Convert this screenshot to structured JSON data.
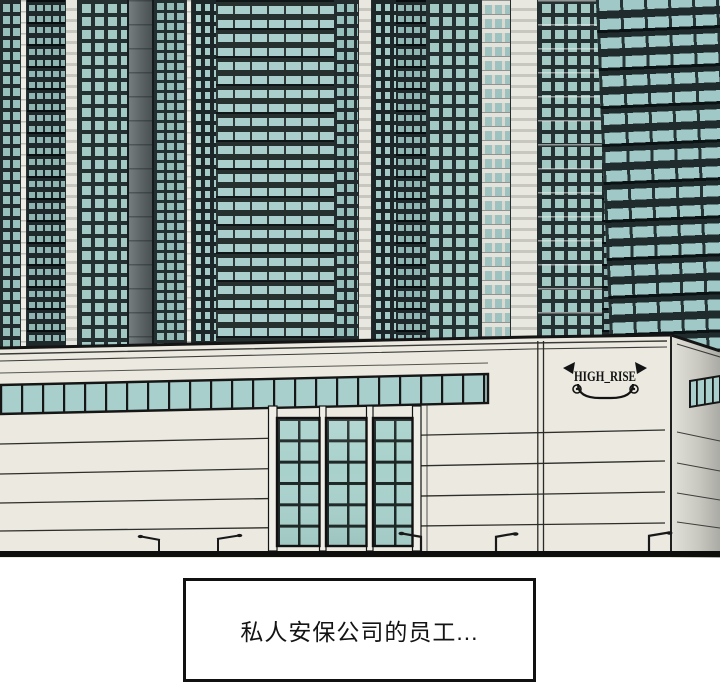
{
  "panel": {
    "type": "webtoon-comic-panel",
    "building_sign": "HIGH_RISE",
    "caption": "私人安保公司的员工...",
    "palette": {
      "tower_facade_dark": "#222c2e",
      "window_teal": "#9fc6c2",
      "wall_cream": "#ebe9e0",
      "wall_shade_right": "#ababa5",
      "entrance_glass": "#a9d1cc",
      "outline_black": "#141414",
      "background_white": "#ffffff"
    }
  }
}
